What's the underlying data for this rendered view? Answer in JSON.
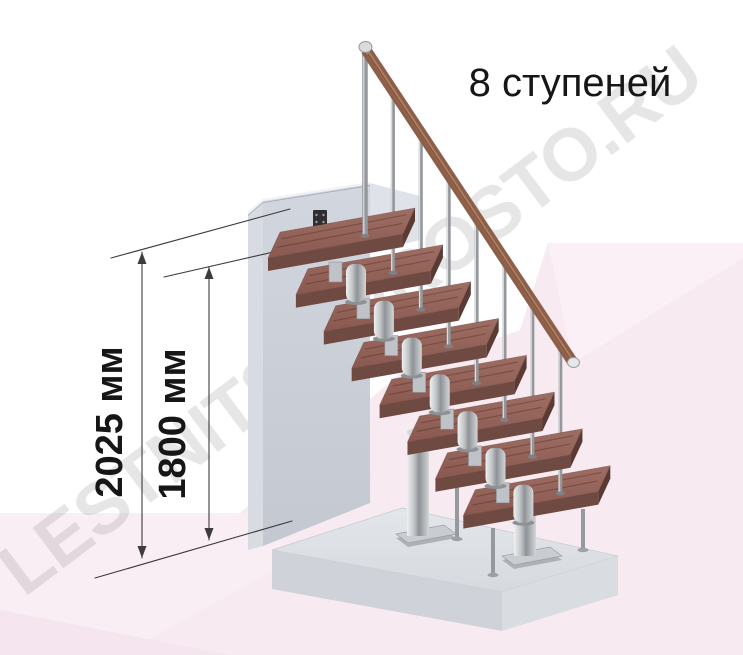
{
  "title": {
    "text": "8 ступеней"
  },
  "annotations": {
    "dim_total": "2025 мм",
    "dim_upper": "1800 мм"
  },
  "watermark": "LESTNITSA-PROSTO.RU",
  "stairs": {
    "step_count": 8
  },
  "colors": {
    "wood_top_light": "#9e6e64",
    "wood_top_dark": "#8a584e",
    "wood_front": "#6f4a42",
    "wood_end": "#5a3a33",
    "handrail": "#8d5e4a",
    "metal_mid": "#a9acb0",
    "wall": "#cbd0d9",
    "platform": "#dde0e5",
    "floor_pink": "#f7eaf1",
    "dimension_line": "#3c3c3e",
    "text": "#161616"
  }
}
